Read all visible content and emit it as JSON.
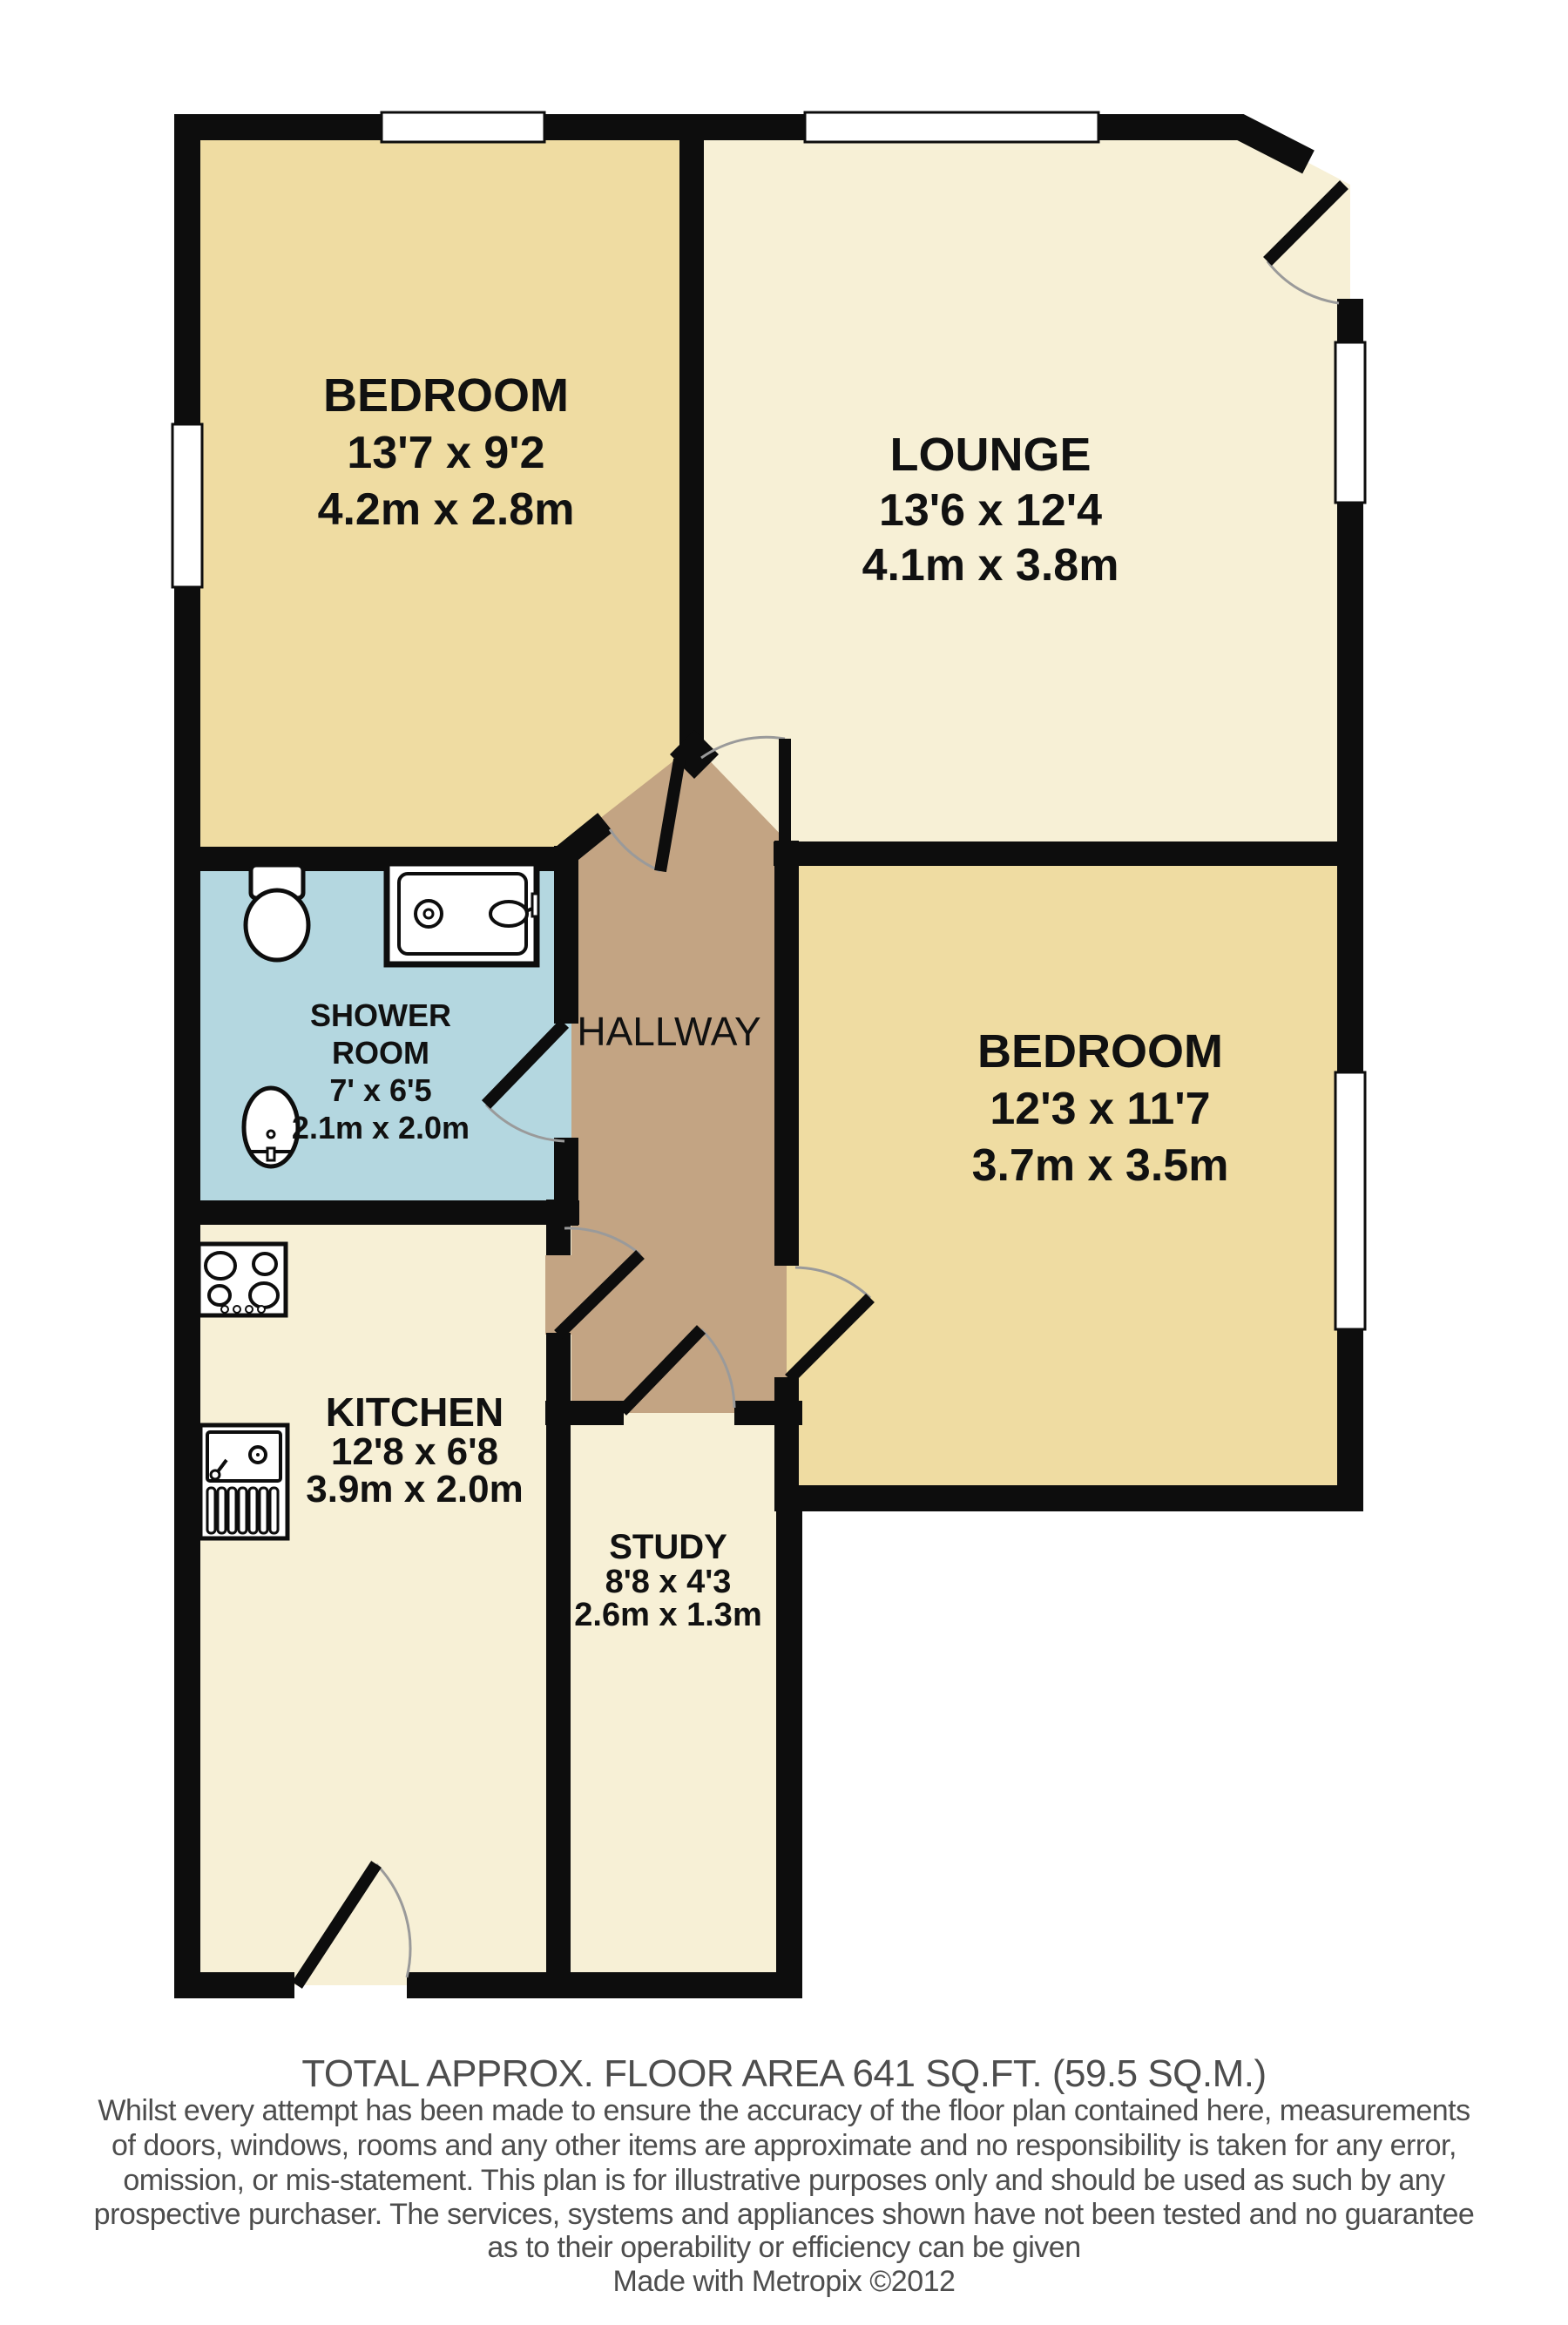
{
  "rooms": {
    "bedroom1": {
      "label": "BEDROOM",
      "imperial": "13'7 x 9'2",
      "metric": "4.2m x 2.8m"
    },
    "lounge": {
      "label": "LOUNGE",
      "imperial": "13'6 x 12'4",
      "metric": "4.1m x 3.8m"
    },
    "shower_room": {
      "label_line1": "SHOWER",
      "label_line2": "ROOM",
      "imperial": "7' x 6'5",
      "metric": "2.1m x 2.0m"
    },
    "hallway": {
      "label": "HALLWAY"
    },
    "bedroom2": {
      "label": "BEDROOM",
      "imperial": "12'3 x 11'7",
      "metric": "3.7m x 3.5m"
    },
    "kitchen": {
      "label": "KITCHEN",
      "imperial": "12'8 x 6'8",
      "metric": "3.9m x 2.0m"
    },
    "study": {
      "label": "STUDY",
      "imperial": "8'8 x 4'3",
      "metric": "2.6m x 1.3m"
    }
  },
  "fixtures": [
    "toilet",
    "wash-basin",
    "shower-tray",
    "cooker-hob",
    "kitchen-sink"
  ],
  "footer": {
    "total_area": "TOTAL APPROX. FLOOR AREA 641 SQ.FT. (59.5 SQ.M.)",
    "disclaimer_lines": [
      "Whilst every attempt has been made to ensure the accuracy of the floor plan contained here, measurements",
      "of doors, windows, rooms and any other items are approximate and no responsibility is taken for any error,",
      "omission, or mis-statement. This plan is for illustrative purposes only and should be used as such by any",
      "prospective purchaser. The services, systems and appliances shown have not been tested and no guarantee",
      "as to their operability or efficiency can be given"
    ],
    "credit": "Made with Metropix ©2012"
  },
  "colors": {
    "bedroom_fill": "#efdca2",
    "living_area_fill": "#f7f0d6",
    "shower_room_fill": "#b4d7e0",
    "hallway_fill": "#c3a483",
    "wall": "#0d0d0d",
    "window": "#ffffff",
    "door_swing_arc": "#9a9a9a",
    "room_label_text": "#111111",
    "footer_text": "#4d4d4d"
  }
}
